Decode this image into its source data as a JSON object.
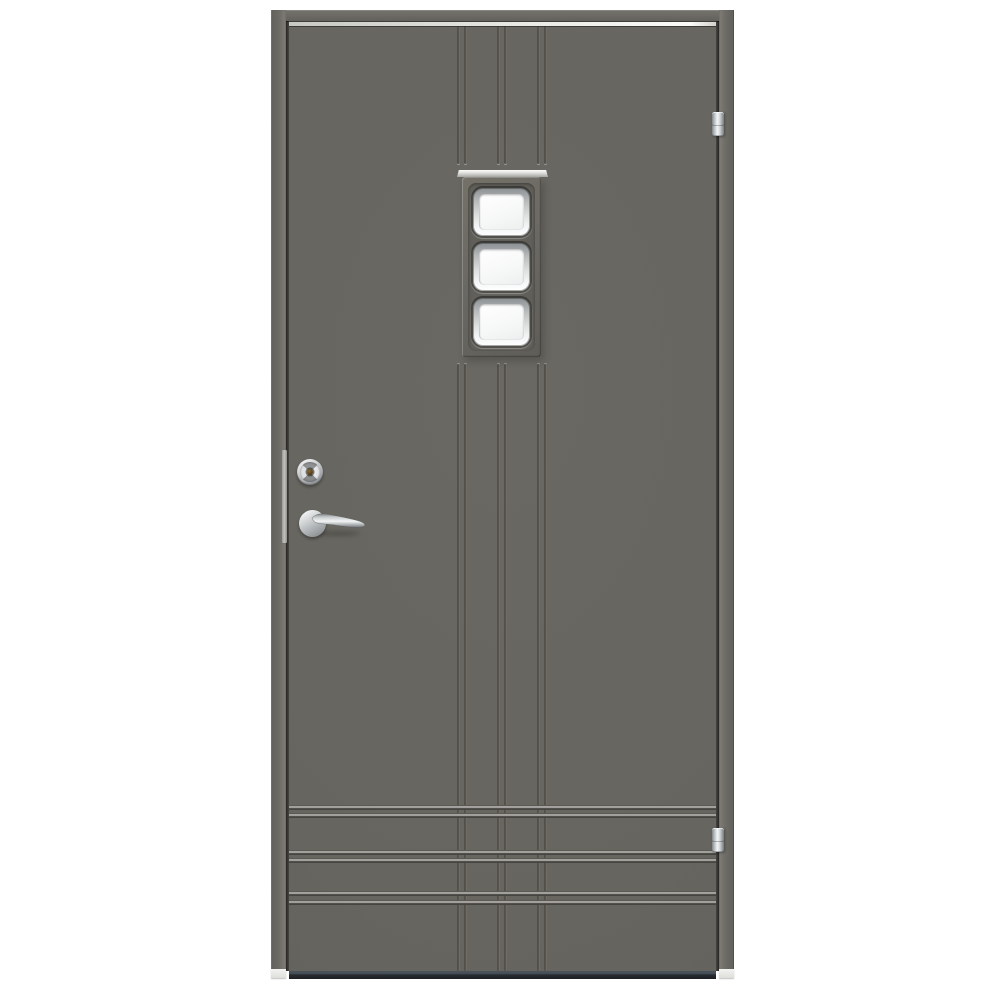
{
  "scene": {
    "type": "product-photo",
    "subject": "Exterior front door, dark grey, shown closed against a white background",
    "door": {
      "color_name": "dark grey",
      "hinge_side": "right",
      "handle_side": "left",
      "window": {
        "pane_count": 3,
        "pane_shape": "rounded square",
        "arrangement": "vertical column, upper middle of door",
        "glass": "clear white",
        "pane_frame_finish": "chrome",
        "drip_cap": "aluminium"
      },
      "hardware": {
        "lever_handle_finish": "chrome",
        "lock_cylinder_finish": "chrome",
        "keyhole_color": "brass",
        "edge_faceplate": "stainless strip",
        "hinge_count": 2,
        "hinge_style": "three-knuckle barrel, chrome"
      },
      "decor_grooves": {
        "vertical_groove_pairs": 3,
        "vertical_groove_zones": [
          "above window to top edge",
          "below window to bottom edge"
        ],
        "horizontal_groove_pairs": 3,
        "horizontal_groove_zone": "lower door, crossing the vertical grooves"
      },
      "threshold": "dark aluminium sill at bottom"
    }
  },
  "colors": {
    "background": "#ffffff",
    "leaf": "#67655f",
    "frame": "#6b6a64",
    "frame_light": "#7c7a73",
    "gap": "#1f1e1c",
    "highlight": "#e6e6e3",
    "groove_light": "#b3b2ae",
    "groove_dark": "#4b4944",
    "vgroove_dark": "#53504a",
    "vgroove_light": "#7a786f",
    "threshold": "#272c31",
    "threshold_top": "#49525a",
    "chrome_bright": "#f4f6f7",
    "chrome_dark": "#8b9094",
    "glass": "#f7f8f8",
    "keyhole": "#4d3814"
  }
}
